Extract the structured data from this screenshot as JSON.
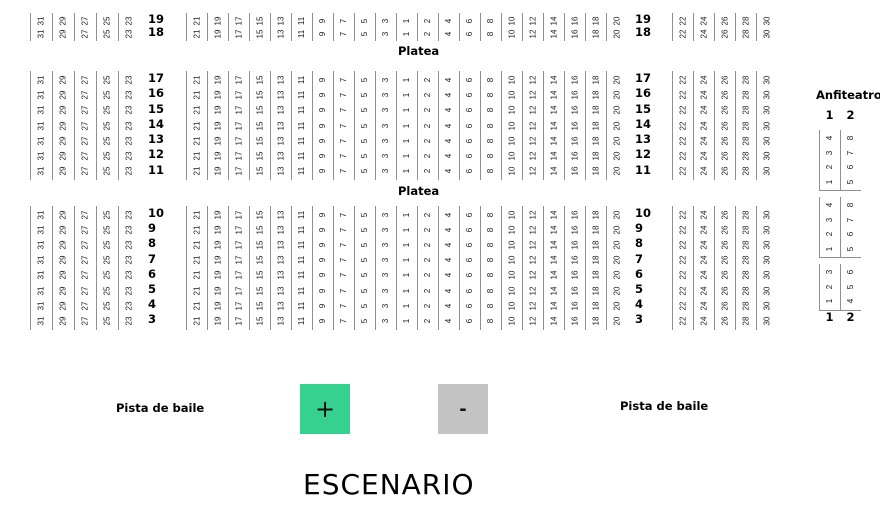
{
  "labels": {
    "platea_top": "Platea",
    "platea_mid": "Platea",
    "anfiteatro": "Anfiteatro",
    "pista_left": "Pista de baile",
    "pista_right": "Pista de baile",
    "escenario": "ESCENARIO",
    "zoom_in": "+",
    "zoom_out": "-"
  },
  "colors": {
    "zoom_in_bg": "#37d18f",
    "zoom_out_bg": "#c3c3c3",
    "seat_line": "#8f8f8f",
    "text": "#000000"
  },
  "seat_columns": {
    "left": [
      31,
      29,
      27,
      25,
      23
    ],
    "center": [
      21,
      19,
      17,
      15,
      13,
      11,
      9,
      7,
      5,
      3,
      1,
      2,
      4,
      6,
      8,
      10,
      12,
      14,
      16,
      18,
      20
    ],
    "right": [
      22,
      24,
      26,
      28,
      30
    ]
  },
  "blocks": [
    {
      "name": "platea-back",
      "rows": [
        19,
        18
      ]
    },
    {
      "name": "platea-middle",
      "rows": [
        17,
        16,
        15,
        14,
        13,
        12,
        11
      ]
    },
    {
      "name": "platea-front",
      "rows": [
        10,
        9,
        8,
        7,
        6,
        5,
        4,
        3
      ]
    }
  ],
  "anfiteatro": {
    "column_labels": [
      "1",
      "2"
    ],
    "groups": [
      {
        "col1": [
          1,
          2,
          3,
          4
        ],
        "col2": [
          5,
          6,
          7,
          8
        ]
      },
      {
        "col1": [
          1,
          2,
          3,
          4
        ],
        "col2": [
          5,
          6,
          7,
          8
        ]
      },
      {
        "col1": [
          1,
          2,
          3
        ],
        "col2": [
          4,
          5,
          6
        ]
      }
    ]
  }
}
